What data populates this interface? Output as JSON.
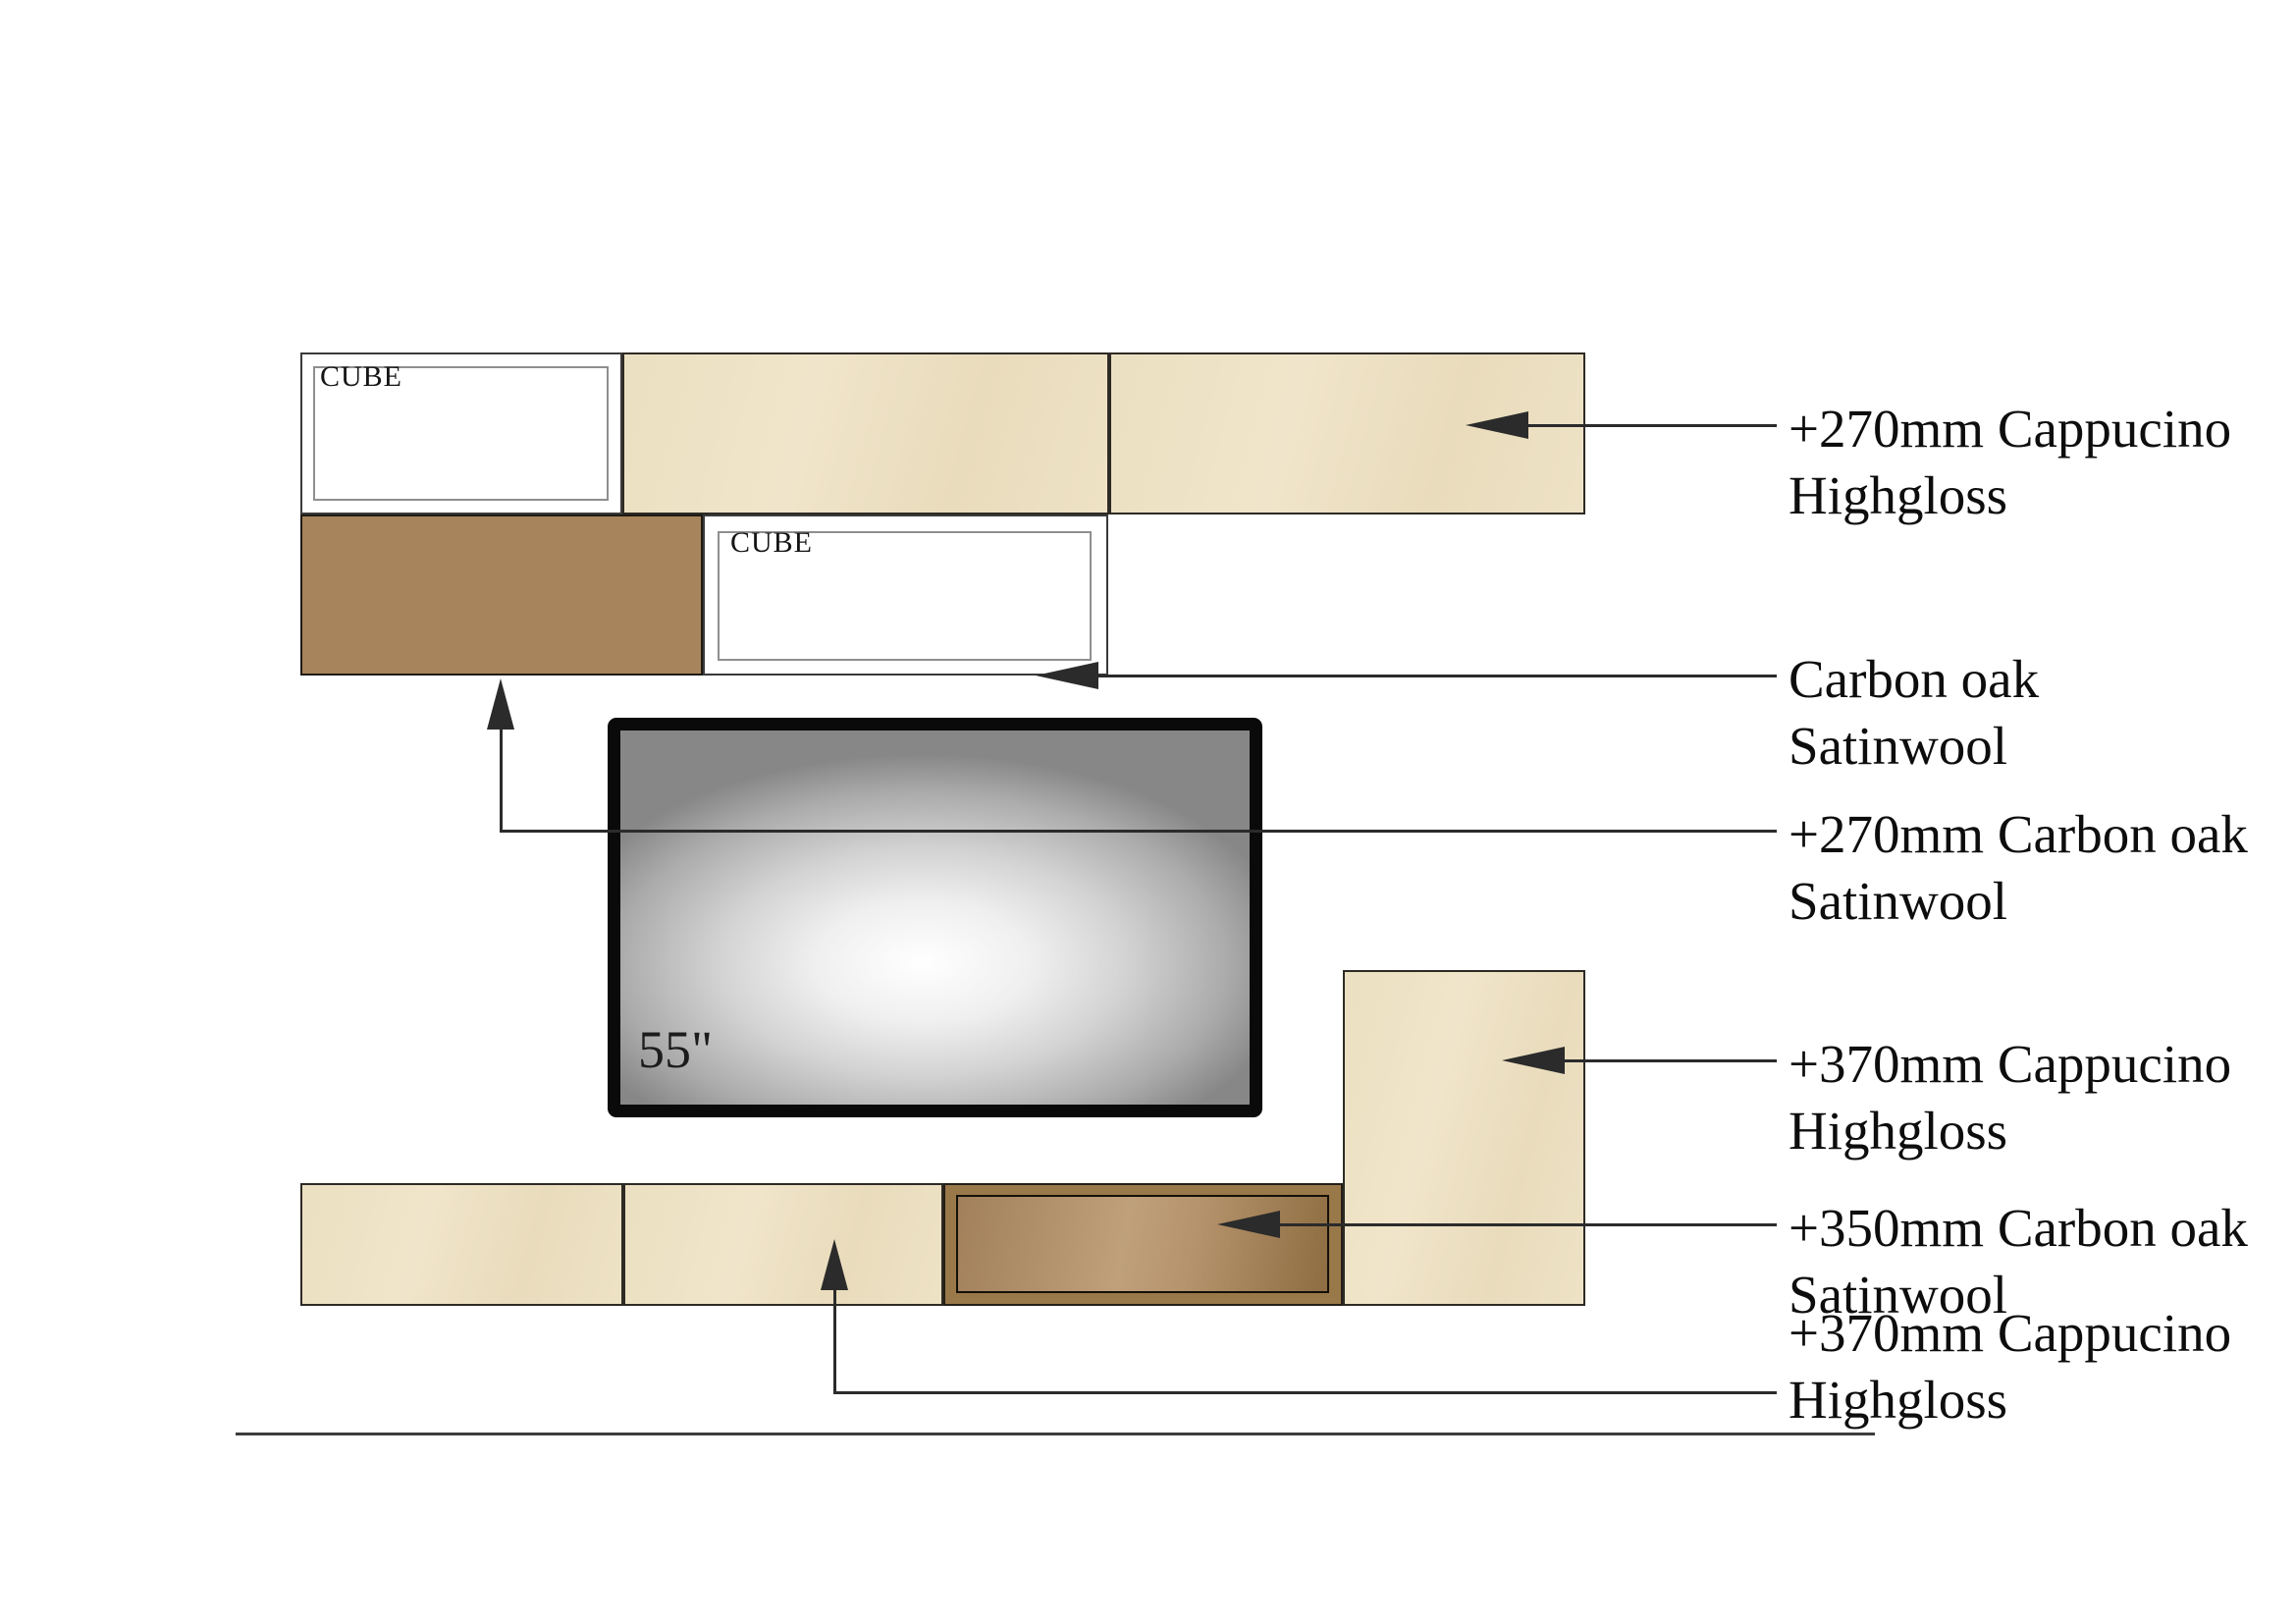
{
  "drawing": {
    "cube_label": "CUBE",
    "tv_size_label": "55\"",
    "callouts": [
      {
        "line1": "+270mm Cappucino",
        "line2": "Highgloss"
      },
      {
        "line1": "Carbon oak",
        "line2": "Satinwool"
      },
      {
        "line1": "+270mm Carbon oak",
        "line2": "Satinwool"
      },
      {
        "line1": "+370mm Cappucino",
        "line2": "Highgloss"
      },
      {
        "line1": "+350mm Carbon oak",
        "line2": "Satinwool"
      },
      {
        "line1": "+370mm Cappucino",
        "line2": "Highgloss"
      }
    ]
  },
  "colors": {
    "cappucino": "#EDE0C4",
    "carbon_oak_panel": "#A7845B",
    "carbon_oak_frame": "#997849",
    "line": "#2B2B2B",
    "background": "#FFFFFF"
  }
}
